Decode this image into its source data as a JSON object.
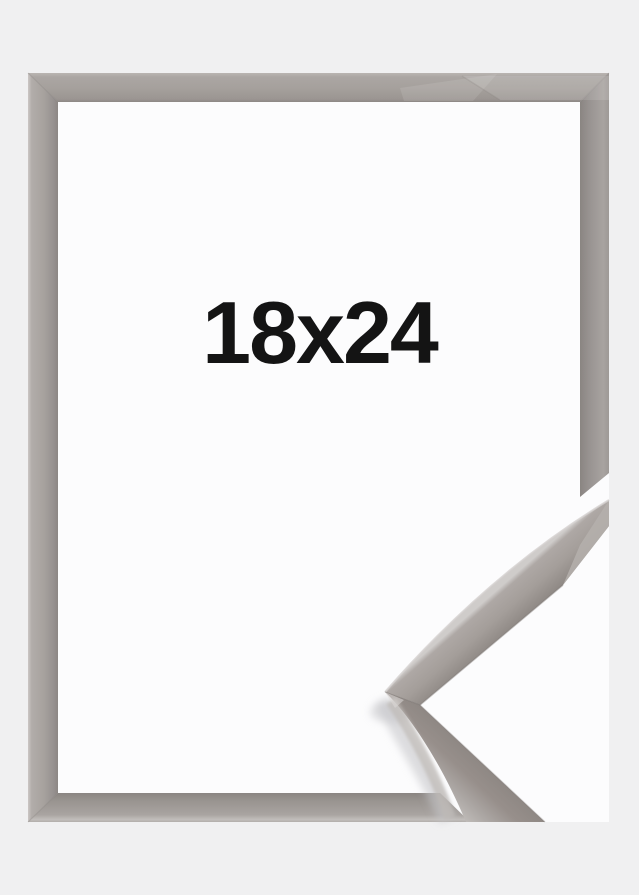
{
  "product": {
    "size_label": "18x24"
  },
  "image": {
    "alt": "Grey silver picture frame shown front-on with a 3D corner profile detail overlapping the bottom right corner",
    "frame_color_name": "grey"
  },
  "colors": {
    "background": "#f0f0f1",
    "surface-white": "#fcfcfd",
    "molding-face": "#a5a09c",
    "molding-highlight": "#c9c5c3",
    "molding-shadow": "#8b8683",
    "label-text": "#141414"
  }
}
